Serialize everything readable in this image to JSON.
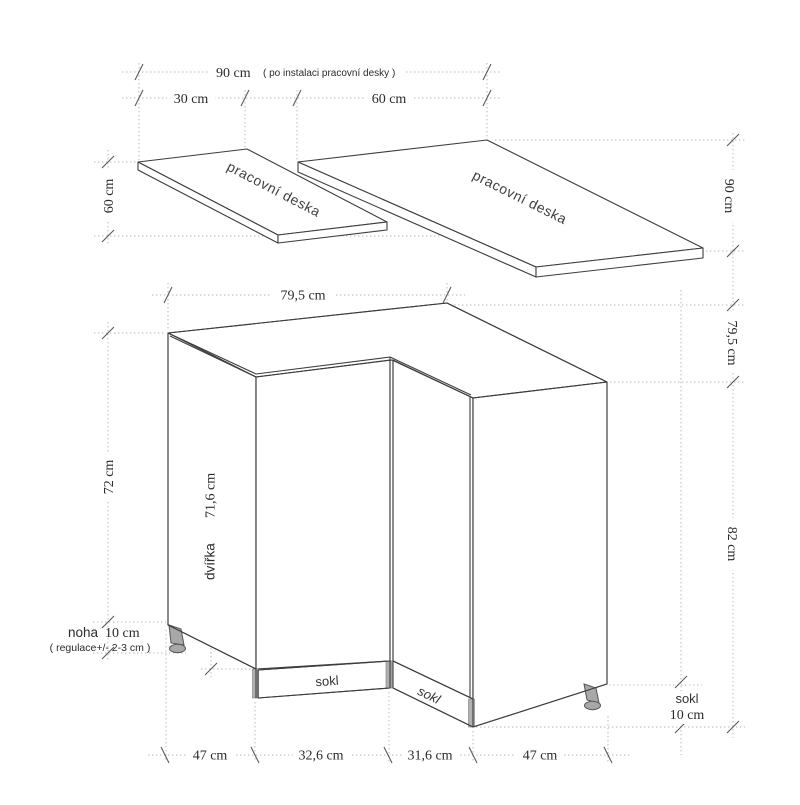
{
  "drawing": {
    "title": "corner kitchen base cabinet dimensional drawing",
    "worktops": {
      "small_label": "pracovní deska",
      "large_label": "pracovní deska",
      "dim_total": "90 cm",
      "dim_total_note": "( po instalaci pracovní desky )",
      "dim_small_width": "30 cm",
      "dim_large_width": "60 cm",
      "dim_small_depth": "60 cm",
      "dim_large_depth": "90 cm"
    },
    "cabinet": {
      "dim_top_width": "79,5 cm",
      "dim_top_depth": "79,5 cm",
      "dim_height_right": "82 cm",
      "dim_body_height": "72 cm",
      "door_label": "dvířka",
      "door_dim": "71,6 cm",
      "leg_label": "noha",
      "leg_dim": "10 cm",
      "leg_note": "( regulace+/- 2-3 cm )",
      "plinth_front_label": "sokl",
      "plinth_side_label": "sokl",
      "plinth_dim_label": "sokl",
      "plinth_dim_value": "10 cm",
      "dim_bottom_left_side": "47 cm",
      "dim_bottom_front_left": "32,6 cm",
      "dim_bottom_front_right": "31,6 cm",
      "dim_bottom_right_side": "47 cm"
    },
    "colors": {
      "line": "#3d3d3d",
      "dotted_guide": "#b6b6b6",
      "tick": "#5a5a5a",
      "leg_fill": "#a8a8a8",
      "background": "#ffffff"
    }
  }
}
